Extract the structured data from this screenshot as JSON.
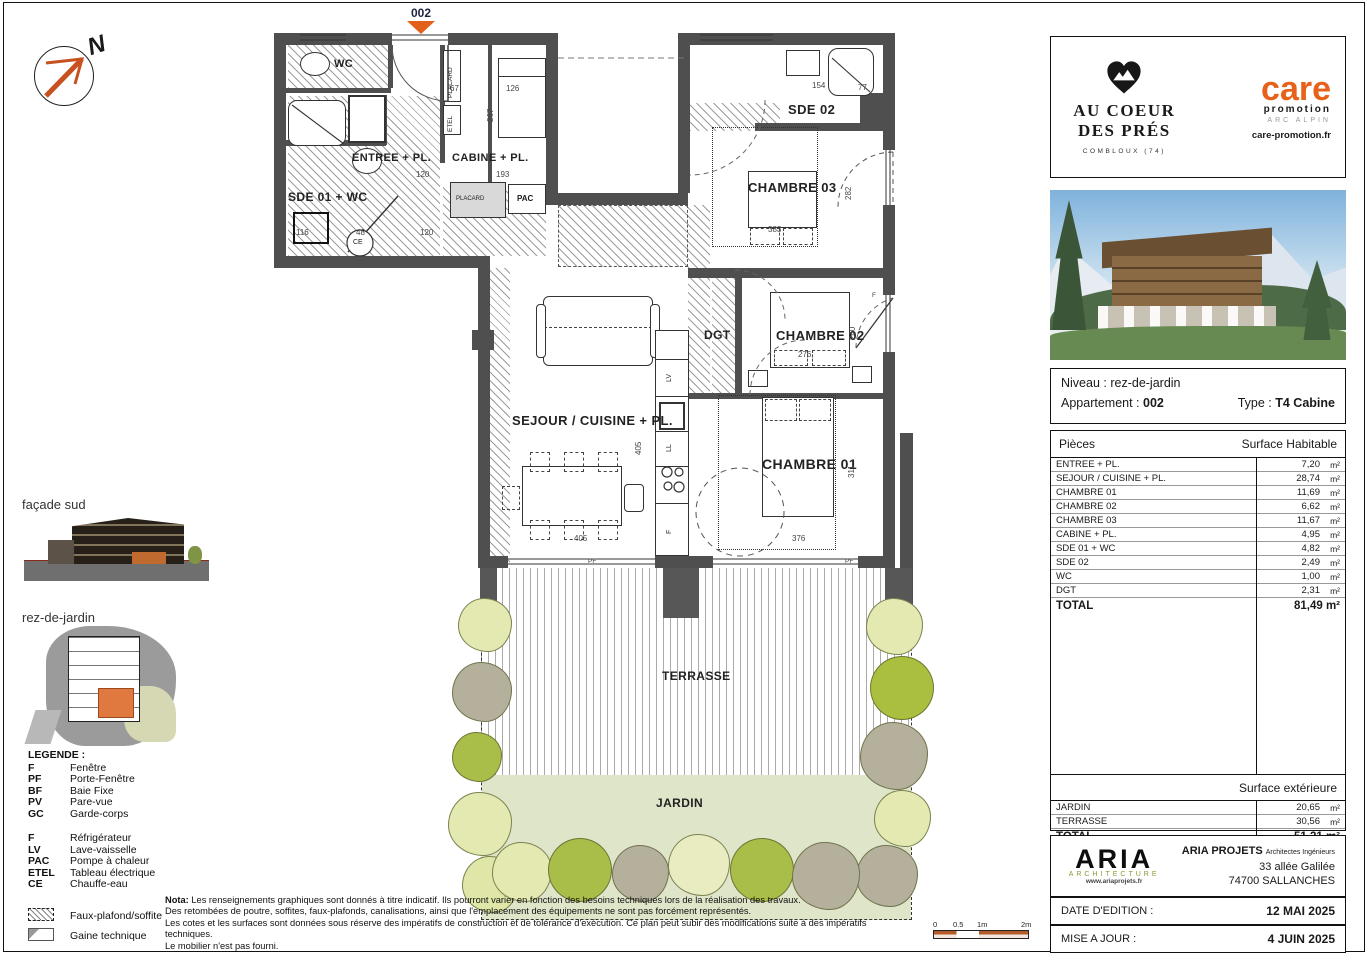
{
  "plan": {
    "unit_marker": "002",
    "north_label": "N",
    "labels": {
      "wc": "WC",
      "entree": "ENTREE + PL.",
      "cabine": "CABINE + PL.",
      "sde01": "SDE 01 + WC",
      "sde02": "SDE 02",
      "ch03": "CHAMBRE 03",
      "ch02": "CHAMBRE 02",
      "ch01": "CHAMBRE 01",
      "dgt": "DGT",
      "sejour": "SEJOUR / CUISINE + PL.",
      "terrasse": "TERRASSE",
      "jardin": "JARDIN",
      "placard_top": "PLACARD",
      "placard_low": "PLACARD",
      "etel": "ETEL",
      "pac": "PAC",
      "ce": "CE",
      "lv": "LV",
      "ll": "LL",
      "f": "F"
    },
    "dims": {
      "a": "120",
      "b": "193",
      "c": "67",
      "d": "126",
      "e": "120",
      "f": "48",
      "g": "116",
      "h": "154",
      "i": "77",
      "j": "383",
      "k": "282",
      "l": "276",
      "m": "240",
      "n": "311",
      "o": "376",
      "p": "405",
      "q": "776",
      "r": "400",
      "s": "405",
      "t": "267",
      "u": "PF",
      "v": "PF",
      "w": "F"
    }
  },
  "side": {
    "facade_label": "façade sud",
    "siteplan_label": "rez-de-jardin",
    "legend": {
      "title": "LEGENDE :",
      "group1": [
        {
          "code": "F",
          "label": "Fenêtre"
        },
        {
          "code": "PF",
          "label": "Porte-Fenêtre"
        },
        {
          "code": "BF",
          "label": "Baie Fixe"
        },
        {
          "code": "PV",
          "label": "Pare-vue"
        },
        {
          "code": "GC",
          "label": "Garde-corps"
        }
      ],
      "group2": [
        {
          "code": "F",
          "label": "Réfrigérateur"
        },
        {
          "code": "LV",
          "label": "Lave-vaisselle"
        },
        {
          "code": "PAC",
          "label": "Pompe à chaleur"
        },
        {
          "code": "ETEL",
          "label": "Tableau électrique"
        },
        {
          "code": "CE",
          "label": "Chauffe-eau"
        }
      ],
      "area1": "Faux-plafond/soffite",
      "area2": "Gaine technique"
    }
  },
  "nota": {
    "title": "Nota:",
    "line1": "Les renseignements graphiques sont donnés à titre indicatif. Ils pourront varier en fonction des besoins techniques lors de la réalisation des travaux.",
    "line2": "Des retombées de poutre, soffites, faux-plafonds, canalisations, ainsi que l'emplacement des équipements ne sont pas forcément représentés.",
    "line3": "Les cotes et les surfaces sont données sous réserve des impératifs de construction et de tolérance d'exécution. Ce plan peut subir des modifications suite à des impératifs techniques.",
    "line4": "Le mobilier n'est pas fourni."
  },
  "scalebar": {
    "t0": "0",
    "t1": "0.5",
    "t2": "1m",
    "t3": "2m"
  },
  "panel": {
    "logo": {
      "title1": "AU COEUR",
      "title2": "DES PRÉS",
      "location": "COMBLOUX (74)",
      "care": "care",
      "promo": "promotion",
      "arc": "ARC ALPIN",
      "site": "care-promotion.fr"
    },
    "info": {
      "niveau_label": "Niveau :",
      "niveau": "rez-de-jardin",
      "apt_label": "Appartement :",
      "apt": "002",
      "type_label": "Type :",
      "type": "T4 Cabine"
    },
    "table": {
      "col1": "Pièces",
      "col2": "Surface Habitable",
      "rows": [
        {
          "label": "ENTREE + PL.",
          "value": "7,20",
          "unit": "m²"
        },
        {
          "label": "SEJOUR / CUISINE + PL.",
          "value": "28,74",
          "unit": "m²"
        },
        {
          "label": "CHAMBRE 01",
          "value": "11,69",
          "unit": "m²"
        },
        {
          "label": "CHAMBRE 02",
          "value": "6,62",
          "unit": "m²"
        },
        {
          "label": "CHAMBRE 03",
          "value": "11,67",
          "unit": "m²"
        },
        {
          "label": "CABINE + PL.",
          "value": "4,95",
          "unit": "m²"
        },
        {
          "label": "SDE 01 + WC",
          "value": "4,82",
          "unit": "m²"
        },
        {
          "label": "SDE 02",
          "value": "2,49",
          "unit": "m²"
        },
        {
          "label": "WC",
          "value": "1,00",
          "unit": "m²"
        },
        {
          "label": "DGT",
          "value": "2,31",
          "unit": "m²"
        }
      ],
      "total_label": "TOTAL",
      "total": "81,49 m²"
    },
    "exterior": {
      "header": "Surface extérieure",
      "rows": [
        {
          "label": "JARDIN",
          "value": "20,65",
          "unit": "m²"
        },
        {
          "label": "TERRASSE",
          "value": "30,56",
          "unit": "m²"
        }
      ],
      "total_label": "TOTAL",
      "total": "51,21 m²"
    },
    "aria": {
      "name": "ARIA",
      "arch": "ARCHITECTURE",
      "url": "www.ariaprojets.fr",
      "firm": "ARIA PROJETS",
      "firm_sub": "Architectes Ingénieurs",
      "addr1": "33 allée Galilée",
      "addr2": "74700 SALLANCHES"
    },
    "dates": {
      "edition_label": "DATE D'EDITION :",
      "edition": "12 MAI 2025",
      "maj_label": "MISE A JOUR :",
      "maj": "4 JUIN 2025"
    }
  },
  "colors": {
    "accent_orange": "#d96a28",
    "care_orange": "#e8611a",
    "wall_grey": "#4f4f4f",
    "aria_olive": "#8a9a33",
    "garden_bg": "#dfe5c9",
    "bush_olive": "#a9bd49",
    "bush_light": "#e4e9b2",
    "bush_grey": "#b4b09c"
  }
}
